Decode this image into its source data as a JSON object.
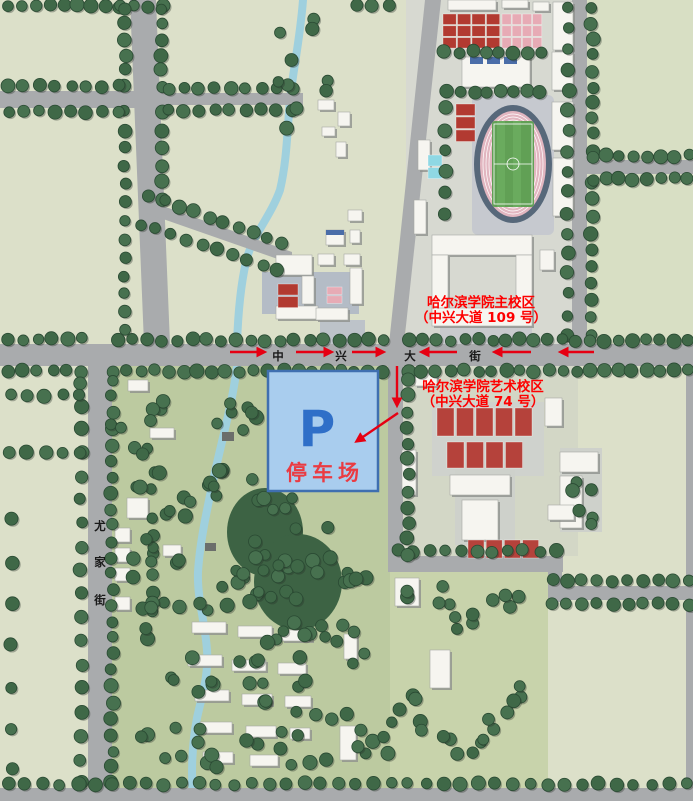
{
  "labels": {
    "campus_main": {
      "line1": "哈尔滨学院主校区",
      "line2": "（中兴大道 109 号）"
    },
    "campus_art": {
      "line1": "哈尔滨学院艺术校区",
      "line2": "（中兴大道 74 号）"
    }
  },
  "streets": {
    "zhongxing": {
      "name": "中兴大街",
      "chars": [
        "中",
        "兴",
        "大",
        "街"
      ]
    },
    "youjia": {
      "name": "尤家街",
      "chars": [
        "尤",
        "家",
        "街"
      ]
    }
  },
  "parking": {
    "symbol": "P",
    "name": "停车场"
  },
  "colors": {
    "label_red": "#fe0000",
    "arrow_red": "#e60012",
    "street_text": "#1a1a1a",
    "parking_fill": "#a9cdee",
    "parking_border": "#3f6fb0",
    "parking_symbol": "#2f6fc8",
    "parking_label": "#ea3b42",
    "road_gray": "#a9abad",
    "field_green": "#dce0c9",
    "park_green": "#bccaa0",
    "tree_green": "#47714f",
    "river_blue": "#9fd0de",
    "court_red": "#b23a31",
    "court_pink": "#e7abb5",
    "building_white": "#f6f5f0",
    "stadium_track": "#e2b6c0",
    "stadium_field": "#61a055"
  }
}
